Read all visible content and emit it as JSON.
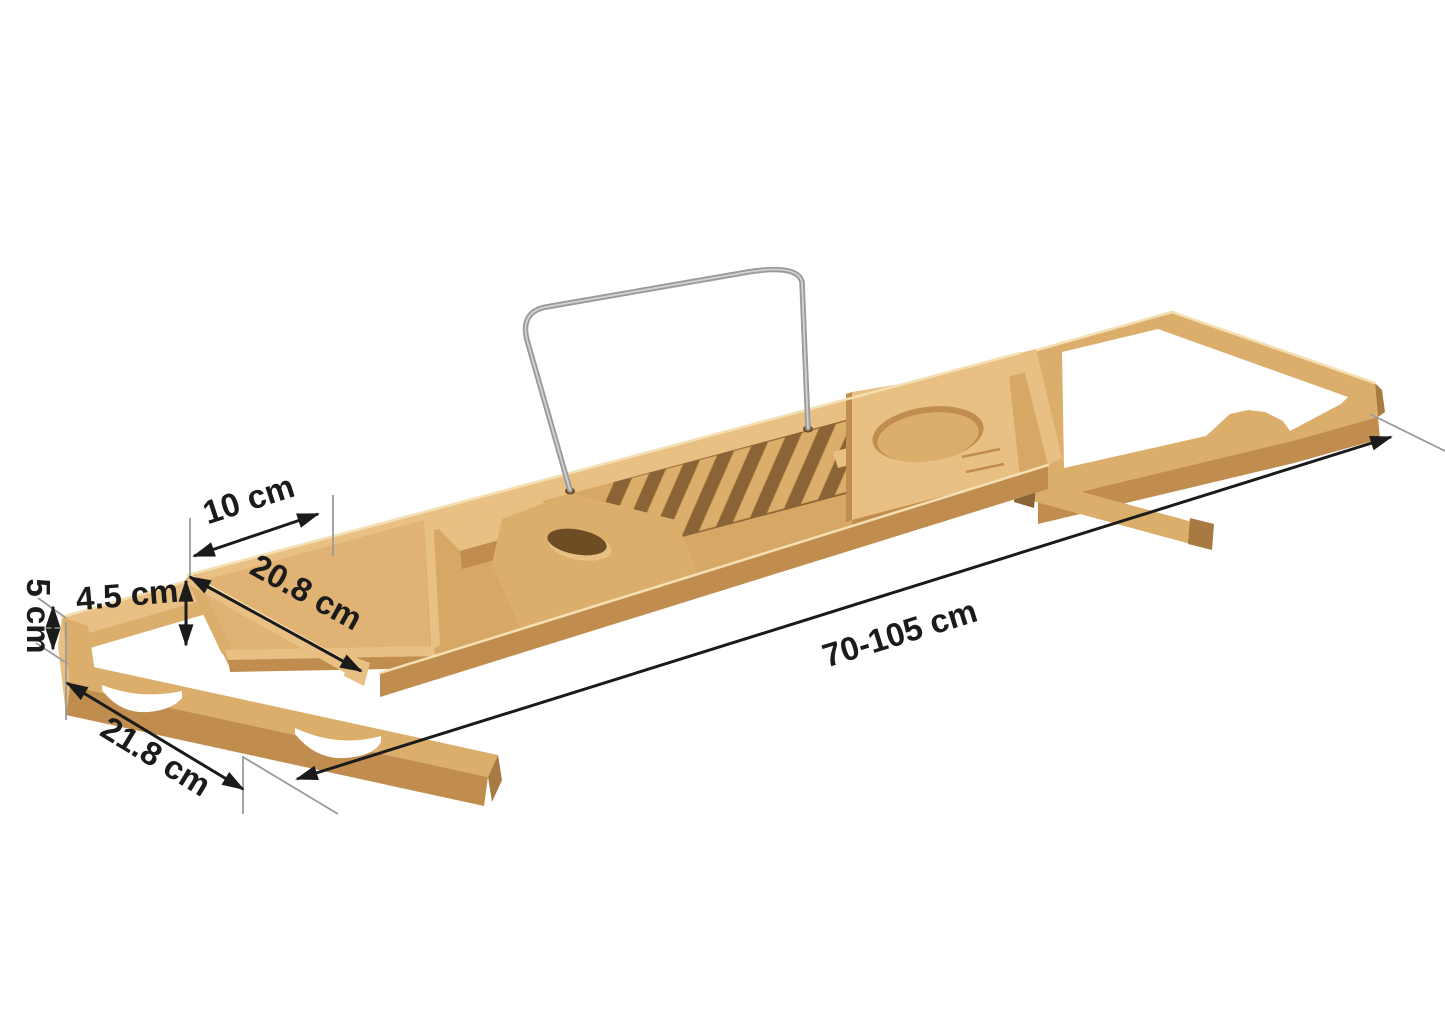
{
  "dimensions": {
    "length": {
      "label": "70-105 cm"
    },
    "end_width": {
      "label": "21.8 cm"
    },
    "divider_diagonal": {
      "label": "20.8 cm"
    },
    "soap_section": {
      "label": "10 cm"
    },
    "rail_width": {
      "label": "4.5 cm"
    },
    "frame_height": {
      "label": "5 cm"
    }
  },
  "colors": {
    "background": "#ffffff",
    "wood_top": "#dcae6c",
    "wood_top_light": "#e8c083",
    "wood_base": "#d6a765",
    "wood_floor": "#e0b273",
    "wood_side": "#c08d4e",
    "wood_side_dark": "#a87a41",
    "wood_gap": "#8a6436",
    "wood_edge_light": "#f3dfb2",
    "metal": "#9a9a9a",
    "metal_light": "#d2d2d2",
    "dim_color": "#1b1b1b",
    "ext_color": "#9b9b9b"
  }
}
